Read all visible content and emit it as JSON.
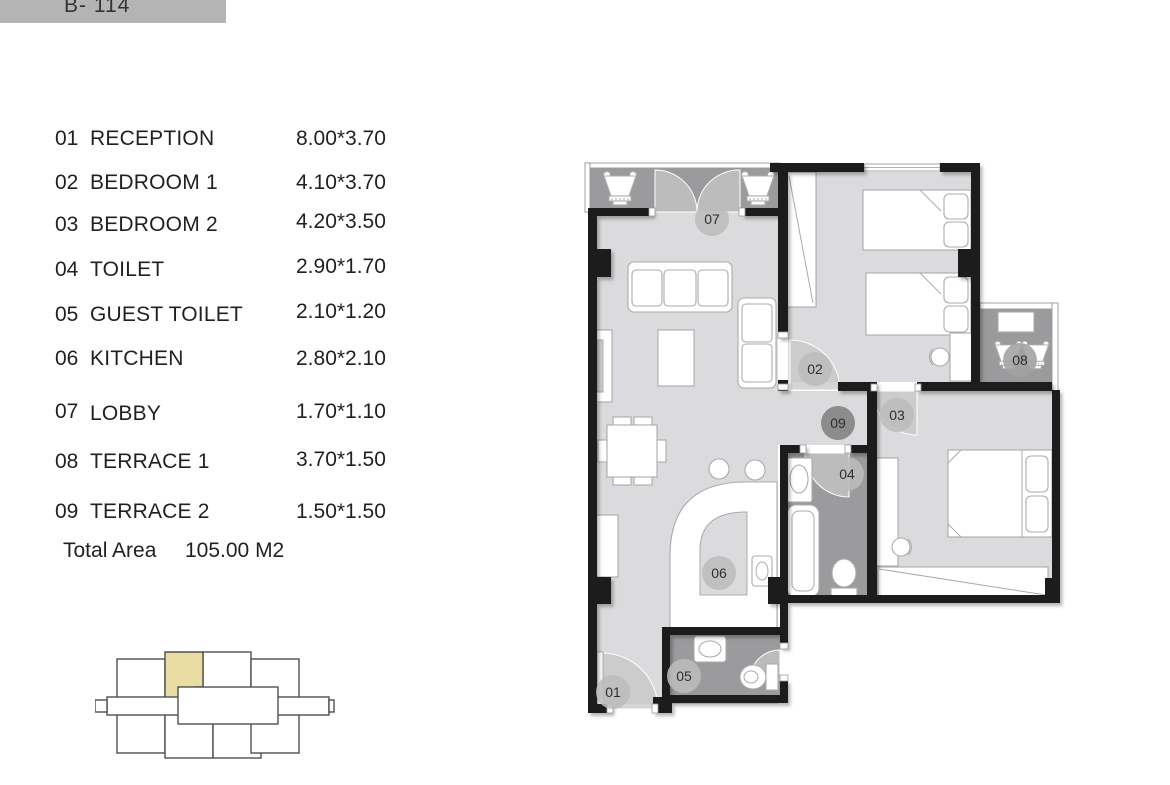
{
  "banner": {
    "label": "B- 114"
  },
  "legend": {
    "rooms": [
      {
        "no": "01",
        "name": "RECEPTION",
        "dim": "8.00*3.70"
      },
      {
        "no": "02",
        "name": "BEDROOM 1",
        "dim": "4.10*3.70"
      },
      {
        "no": "03",
        "name": "BEDROOM 2",
        "dim": "4.20*3.50"
      },
      {
        "no": "04",
        "name": "TOILET",
        "dim": "2.90*1.70"
      },
      {
        "no": "05",
        "name": "GUEST TOILET",
        "dim": "2.10*1.20"
      },
      {
        "no": "06",
        "name": "KITCHEN",
        "dim": "2.80*2.10"
      },
      {
        "no": "07",
        "name": "LOBBY",
        "dim": "1.70*1.10"
      },
      {
        "no": "08",
        "name": "TERRACE 1",
        "dim": "3.70*1.50"
      },
      {
        "no": "09",
        "name": "TERRACE 2",
        "dim": "1.50*1.50"
      }
    ],
    "total_label": "Total Area",
    "total_value": "105.00 M2"
  },
  "colors": {
    "wall": "#1d1d1f",
    "floor_light": "#dbdbdd",
    "floor_dark": "#9b9b9d",
    "banner_bg": "#b4b4b4",
    "highlight": "#e9dda4",
    "marker": "#bcbcbc",
    "marker_dark": "#8c8c8c"
  }
}
